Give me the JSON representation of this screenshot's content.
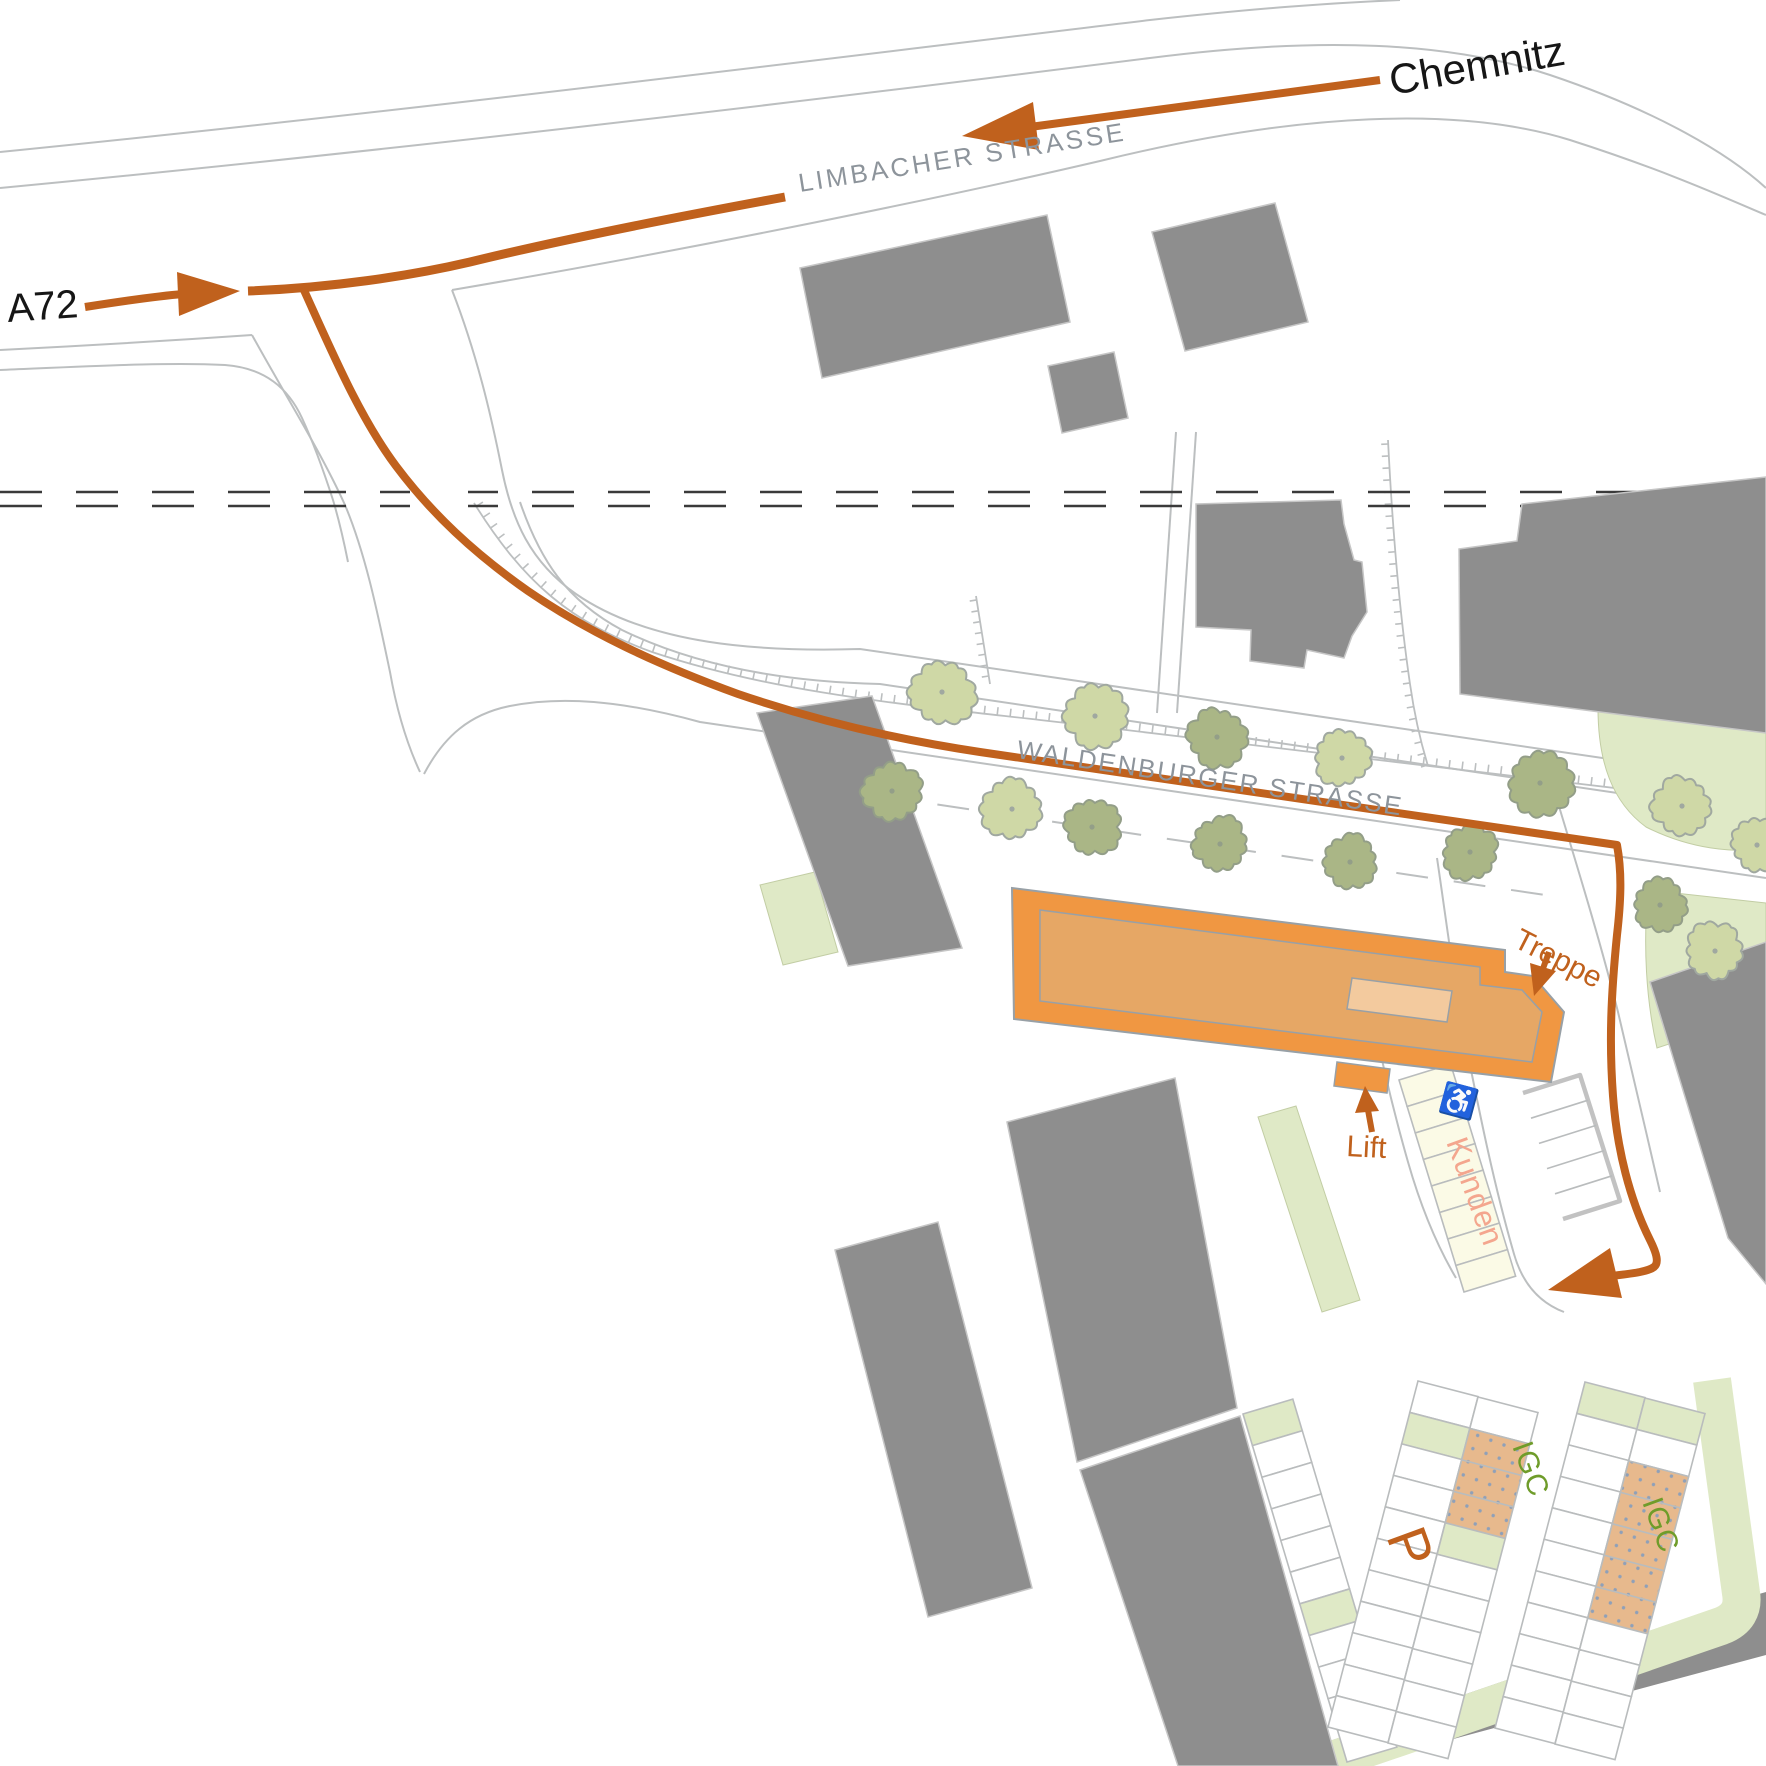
{
  "map_title": "Anfahrtsskizze Innenstadt (site access map)",
  "colors": {
    "route": "#c0611d",
    "label_orange": "#c0611d",
    "street_name": "#8d949b",
    "black_label": "#161616",
    "road_line": "#bcbfc0",
    "railway": "#3a3a3a",
    "building_gray": "#8e8e8e",
    "building_gray_stroke": "#c6c6c6",
    "bld_outer": "#f09742",
    "bld_inner": "#e6a765",
    "bld_roof": "#f3ca9e",
    "bld_stroke": "#98a0a6",
    "lawn": "#dfe9c6",
    "lawn_stroke": "#c2cda4",
    "tree_a_fill": "#cfd8a6",
    "tree_a_stroke": "#a0a8a0",
    "tree_b_fill": "#aab686",
    "tree_b_stroke": "#939e88",
    "stall_stroke": "#b9bcbd",
    "cream": "#fbfae6",
    "tan": "#e7b98d",
    "tan_dot": "#8fa0b8",
    "kunden_text": "#f4a68e",
    "igc_text": "#6f9c2a"
  },
  "labels": {
    "chemnitz": {
      "text": "Chemnitz",
      "x": 1392,
      "y": 95,
      "rot": -10,
      "size": 42,
      "color": "#161616",
      "ls": 0
    },
    "a72": {
      "text": "A72",
      "x": 8,
      "y": 322,
      "rot": -4,
      "size": 40,
      "color": "#161616",
      "ls": 0
    },
    "limbacher": {
      "text": "LIMBACHER STRASSE",
      "x": 800,
      "y": 192,
      "rot": -9,
      "size": 26,
      "color": "#8d949b",
      "ls": 3
    },
    "waldenburger": {
      "text": "WALDENBURGER STRASSE",
      "x": 1016,
      "y": 758,
      "rot": 8.5,
      "size": 26,
      "color": "#8d949b",
      "ls": 2
    },
    "treppe": {
      "text": "Treppe",
      "x": 1512,
      "y": 946,
      "rot": 27,
      "size": 30,
      "color": "#c0611d",
      "ls": 0
    },
    "lift": {
      "text": "Lift",
      "x": 1346,
      "y": 1156,
      "rot": 3,
      "size": 30,
      "color": "#c0611d",
      "ls": 0
    },
    "kunden": {
      "text": "Kunden",
      "x": 1446,
      "y": 1142,
      "rot": 70,
      "size": 31,
      "color": "#f4a68e",
      "ls": 1
    },
    "p": {
      "text": "P",
      "x": 1386,
      "y": 1536,
      "rot": 70,
      "size": 56,
      "color": "#c0611d",
      "ls": 0
    },
    "igc1": {
      "text": "IGC",
      "x": 1512,
      "y": 1446,
      "rot": 70,
      "size": 30,
      "color": "#6f9c2a",
      "ls": 1
    },
    "igc2": {
      "text": "IGC",
      "x": 1642,
      "y": 1502,
      "rot": 70,
      "size": 30,
      "color": "#6f9c2a",
      "ls": 1
    },
    "wheelchair_icon": {
      "text": "♿",
      "x": 1438,
      "y": 1106,
      "rot": 15,
      "size": 30,
      "color": "#161616",
      "ls": 0
    }
  },
  "roads": [
    {
      "name": "limbacher-north-outer",
      "d": "M 0,152 C 400,112 800,62 1150,20 C 1260,8 1330,3 1400,0"
    },
    {
      "name": "limbacher-north-inner",
      "d": "M 0,188 C 400,150 800,102 1150,58 C 1320,36 1450,42 1550,75 C 1660,112 1730,155 1766,188"
    },
    {
      "name": "a72-north-edge",
      "d": "M 0,350 C 100,345 180,340 252,335"
    },
    {
      "name": "junction-west-edge",
      "d": "M 252,335 C 285,395 320,450 345,505 C 366,555 378,615 390,672 C 396,706 406,742 420,772"
    },
    {
      "name": "a72-south-edge",
      "d": "M 0,370 C 95,366 170,362 225,365 C 265,368 288,388 302,418 C 314,444 324,472 333,500 C 339,520 344,542 348,562"
    },
    {
      "name": "limbacher-south-edge",
      "d": "M 452,290 C 700,248 950,196 1100,161 C 1300,112 1460,106 1570,140 C 1670,172 1730,200 1766,215"
    },
    {
      "name": "waldenburger-north-outer",
      "d": "M 452,290 C 480,362 494,430 502,470 C 512,520 530,562 576,594 C 650,645 760,652 860,649 L 1766,782"
    },
    {
      "name": "waldenburger-north-inner",
      "d": "M 520,502 C 540,560 566,600 622,630 C 700,668 790,682 880,684 L 1766,815"
    },
    {
      "name": "waldenburger-south-edge",
      "d": "M 424,774 C 444,736 470,714 510,706 C 560,696 620,700 700,722 L 1766,878"
    },
    {
      "name": "waldenburger-parking-dash",
      "d": "M 880,796 L 1545,895",
      "dash": "32 26"
    },
    {
      "name": "parcel-line-1",
      "d": "M 1176,432 L 1157,713"
    },
    {
      "name": "parcel-line-2",
      "d": "M 1196,432 L 1177,713"
    },
    {
      "name": "drive-east-1",
      "d": "M 1437,858 C 1447,925 1454,985 1468,1055 C 1480,1115 1494,1185 1514,1254 C 1522,1282 1538,1302 1564,1312"
    },
    {
      "name": "drive-east-2",
      "d": "M 1360,946 C 1372,1020 1388,1092 1408,1162 C 1420,1204 1436,1244 1456,1278"
    },
    {
      "name": "sidewalk-east",
      "d": "M 1545,760 C 1572,850 1598,932 1618,1012 C 1632,1070 1646,1132 1660,1192"
    }
  ],
  "hatches": [
    {
      "name": "embankment-hatch",
      "d": "M 474,503 C 524,583 570,622 652,652 C 772,692 900,704 1040,720 C 1250,744 1450,768 1766,806",
      "spacing": 13,
      "len": 8,
      "side": 1
    },
    {
      "name": "parcel-hatch",
      "d": "M 1388,440 C 1392,520 1398,602 1410,684 C 1414,712 1420,740 1428,766",
      "spacing": 12,
      "len": 7,
      "side": -1
    },
    {
      "name": "stall-ladder",
      "d": "M 976,596 L 990,684",
      "spacing": 11,
      "len": 7,
      "side": -1
    }
  ],
  "railway": {
    "y1": 492,
    "y2": 506,
    "dash": "42 34",
    "gap": {
      "x": 410,
      "y": 480,
      "w": 58,
      "h": 36
    }
  },
  "lawns": [
    {
      "name": "lawn-east-upper",
      "d": "M 1598,708 C 1598,762 1612,802 1646,827 C 1692,850 1732,852 1766,850 L 1766,730 Z"
    },
    {
      "name": "lawn-east-lower",
      "d": "M 1648,890 C 1643,945 1646,1000 1657,1048 L 1766,1012 L 1766,903 Z"
    },
    {
      "name": "lawn-plaza-strip",
      "d": "M 1258,1117 L 1296,1106 L 1360,1300 L 1322,1312 Z"
    },
    {
      "name": "lawn-west-strip",
      "d": "M 760,885 L 815,872 L 838,952 L 783,965 Z"
    }
  ],
  "promenade": {
    "name": "parking-green-band",
    "d": "M 1712,1380 L 1741,1593 Q 1745,1617 1721,1626 L 1400,1737 L 1230,1795",
    "width": 38
  },
  "gray_band": {
    "name": "south-road-band",
    "d": "M 1257,1766 L 1745,1598 L 1766,1592 L 1766,1655 L 1353,1766 Z"
  },
  "buildings": [
    {
      "name": "building-limbacher-large",
      "d": "M 800,268 L 1047,215 L 1070,322 L 822,378 Z"
    },
    {
      "name": "building-limbacher-small",
      "d": "M 1048,366 L 1114,352 L 1128,418 L 1062,433 Z"
    },
    {
      "name": "building-limbacher-east",
      "d": "M 1152,232 L 1275,203 L 1308,322 L 1185,351 Z"
    },
    {
      "name": "building-mid-house",
      "d": "M 1196,504 L 1341,500 L 1344,524 L 1354,560 L 1362,562 L 1367,612 L 1352,636 L 1344,658 L 1307,650 L 1304,668 L 1250,661 L 1251,630 L 1196,627 Z"
    },
    {
      "name": "building-east-block",
      "d": "M 1459,549 L 1517,541 L 1522,504 L 1766,477 L 1766,733 L 1600,712 L 1460,694 Z"
    },
    {
      "name": "building-east-lower",
      "d": "M 1650,982 L 1766,942 L 1766,1284 L 1728,1238 Z"
    },
    {
      "name": "building-west-slab",
      "d": "M 757,713 L 872,696 L 962,948 L 848,966 Z"
    },
    {
      "name": "building-south-large",
      "d": "M 1007,1122 L 1175,1078 L 1237,1408 L 1077,1462 Z"
    },
    {
      "name": "building-south-lower",
      "d": "M 1080,1470 L 1240,1416 L 1338,1766 L 1178,1766 Z"
    },
    {
      "name": "building-southwest-slab",
      "d": "M 835,1250 L 938,1222 L 1032,1588 L 928,1617 Z"
    }
  ],
  "parking_strips": [
    {
      "name": "stalls-west-column",
      "from": [
        1243,
        1414
      ],
      "to": [
        1347,
        1762
      ],
      "w": 52,
      "n": 11,
      "fills": {
        "0": "g",
        "6": "g"
      }
    },
    {
      "name": "stalls-mid-left",
      "from": [
        1418,
        1381
      ],
      "to": [
        1328,
        1727
      ],
      "w": 62,
      "n": 11,
      "fills": {
        "1": "g"
      }
    },
    {
      "name": "stalls-mid-right",
      "from": [
        1478,
        1397
      ],
      "to": [
        1388,
        1743
      ],
      "w": 62,
      "n": 11,
      "fills": {
        "1": "t",
        "2": "t",
        "3": "t",
        "4": "g"
      }
    },
    {
      "name": "stalls-east-left",
      "from": [
        1585,
        1382
      ],
      "to": [
        1495,
        1728
      ],
      "w": 62,
      "n": 11,
      "fills": {
        "0": "g"
      }
    },
    {
      "name": "stalls-east-right",
      "from": [
        1645,
        1398
      ],
      "to": [
        1555,
        1744
      ],
      "w": 62,
      "n": 11,
      "fills": {
        "0": "g",
        "2": "t",
        "3": "t",
        "4": "t",
        "5": "t",
        "6": "t"
      }
    },
    {
      "name": "stalls-kunden",
      "from": [
        1399,
        1080
      ],
      "to": [
        1464,
        1292
      ],
      "w": 54,
      "n": 8,
      "fills": {},
      "cell": "#fbfae6"
    }
  ],
  "outlined_lot": {
    "name": "parking-outlined",
    "pts": [
      [
        1523,
        1093
      ],
      [
        1580,
        1075
      ],
      [
        1620,
        1201
      ],
      [
        1563,
        1219
      ]
    ],
    "rungs": 4
  },
  "trees": [
    [
      942,
      692,
      "a",
      31
    ],
    [
      1095,
      716,
      "a",
      30
    ],
    [
      1217,
      737,
      "b",
      28
    ],
    [
      1342,
      758,
      "a",
      27
    ],
    [
      1540,
      783,
      "b",
      30
    ],
    [
      1682,
      806,
      "a",
      28
    ],
    [
      892,
      791,
      "b",
      28
    ],
    [
      1012,
      809,
      "a",
      29
    ],
    [
      1092,
      827,
      "b",
      27
    ],
    [
      1220,
      844,
      "b",
      26
    ],
    [
      1350,
      862,
      "b",
      26
    ],
    [
      1470,
      852,
      "b",
      26
    ],
    [
      1660,
      905,
      "b",
      25
    ],
    [
      1715,
      951,
      "a",
      27
    ],
    [
      1757,
      845,
      "a",
      24
    ]
  ],
  "main_building": {
    "name": "destination-building",
    "outer": "M 1012,888 L 1505,950 L 1505,972 L 1533,976 L 1564,1012 L 1551,1082 L 1014,1019 Z",
    "inner": "M 1040,910 L 1480,967 L 1480,985 L 1522,990 L 1542,1012 L 1532,1062 L 1040,1001 Z",
    "roof": "M 1352,978 L 1452,991 L 1447,1022 L 1347,1009 Z",
    "lift_bump": "M 1337,1062 L 1390,1069 L 1387,1093 L 1334,1086 Z",
    "notch": "M 1086,1030 L 1112,1034 L 1110,1052 L 1084,1048 Z"
  },
  "route": {
    "segments": [
      {
        "name": "route-from-chemnitz",
        "d": "M 1380,80 L 1030,127",
        "w": 8
      },
      {
        "name": "route-limbacher",
        "d": "M 785,197 C 660,220 560,240 470,262 C 410,276 330,288 248,291",
        "w": 9
      },
      {
        "name": "route-main",
        "d": "M 303,288 C 332,352 360,418 396,466 C 432,514 474,553 528,591 C 588,632 656,664 738,694 C 820,722 900,740 980,752 L 1617,845 C 1622,872 1621,900 1617,935 C 1611,995 1609,1042 1613,1096 C 1617,1150 1630,1200 1650,1240 C 1657,1254 1659,1263 1654,1267 C 1646,1273 1625,1274 1596,1278",
        "w": 8
      },
      {
        "name": "route-from-a72",
        "d": "M 85,307 C 130,300 158,296 183,294",
        "w": 8
      },
      {
        "name": "treppe-arrow-shaft",
        "d": "M 1549,952 L 1541,974",
        "w": 6
      },
      {
        "name": "lift-arrow-shaft",
        "d": "M 1372,1132 L 1368,1110",
        "w": 6
      }
    ],
    "arrowheads": [
      {
        "name": "chemnitz-arrowhead",
        "pts": "962,136 1033,102 1039,150"
      },
      {
        "name": "a72-arrowhead",
        "pts": "240,291 179,316 177,272"
      },
      {
        "name": "destination-arrowhead",
        "pts": "1548,1290 1610,1248 1622,1298"
      },
      {
        "name": "treppe-arrowhead",
        "pts": "1534,996 1530,963 1556,971"
      },
      {
        "name": "lift-arrowhead",
        "pts": "1365,1086 1379,1111 1355,1113"
      }
    ]
  }
}
